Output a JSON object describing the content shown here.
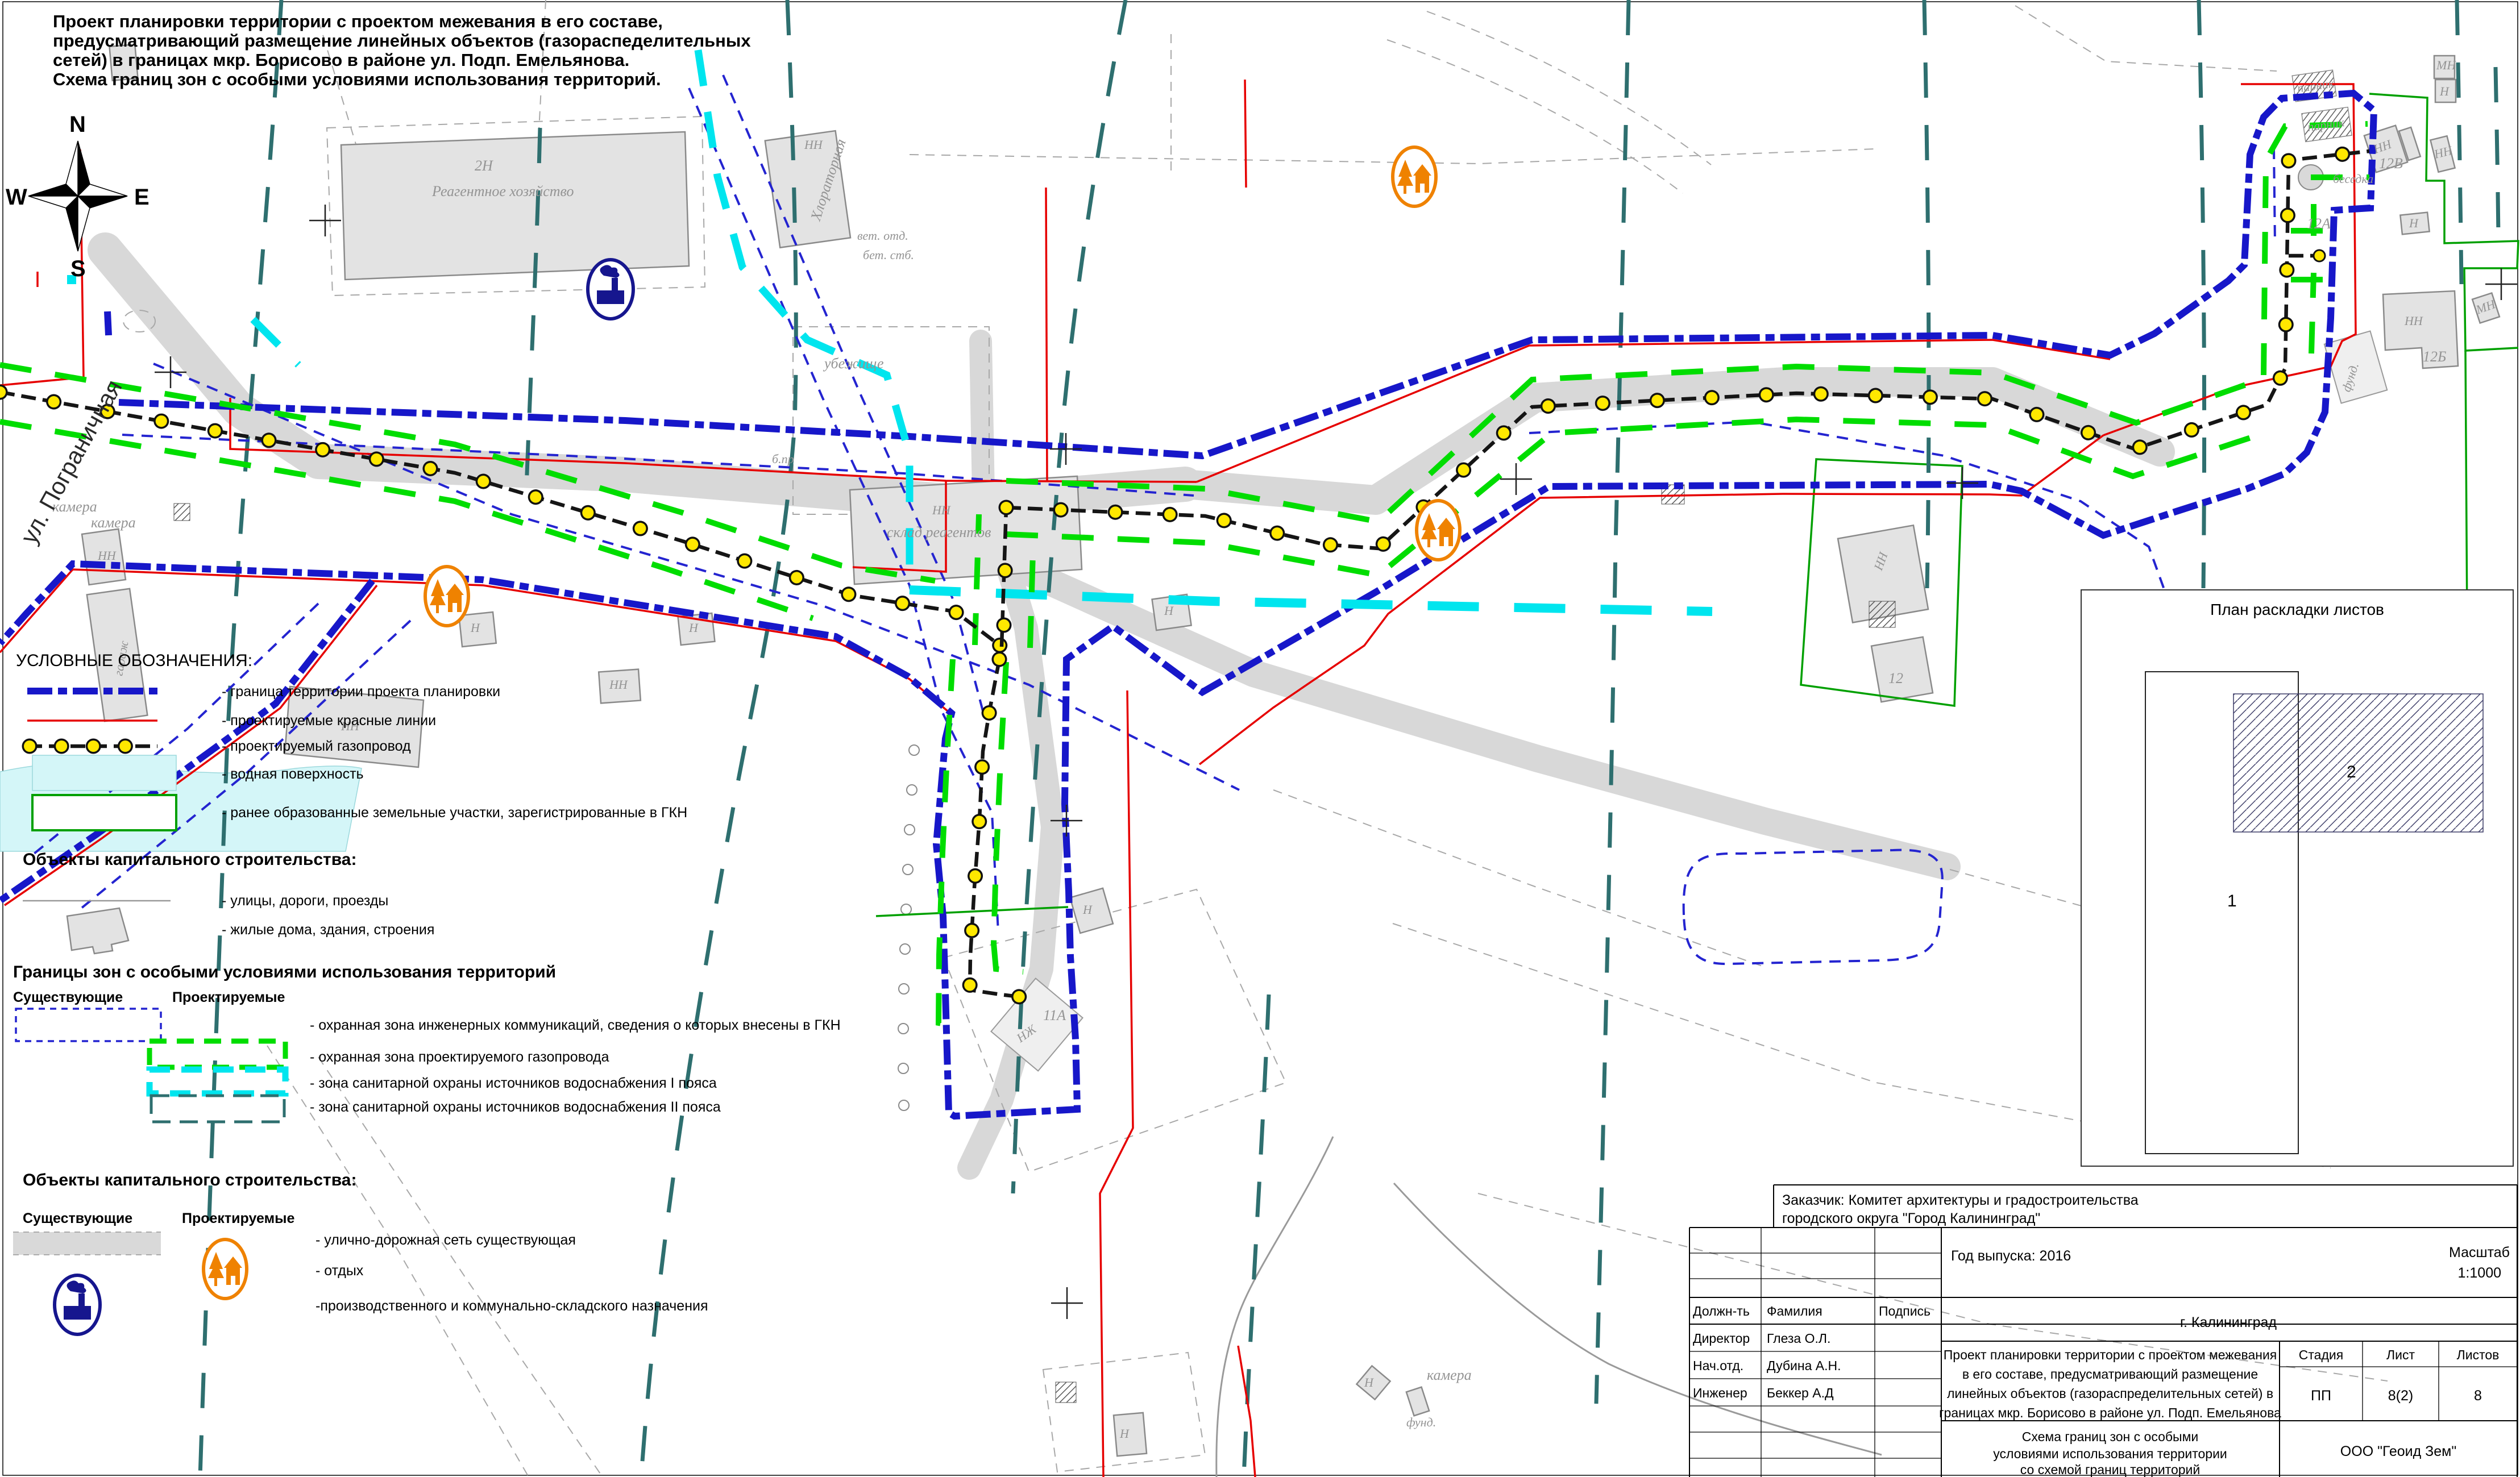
{
  "title": {
    "lines": [
      "Проект планировки территории с проектом межевания в его составе,",
      "предусматривающий размещение линейных объектов (газораспеделительных",
      "сетей) в границах мкр. Борисово в районе ул. Подп. Емельянова.",
      "Схема границ зон с особыми условиями использования территорий."
    ]
  },
  "compass": {
    "n": "N",
    "s": "S",
    "e": "E",
    "w": "W"
  },
  "colors": {
    "project_boundary": "#1717c9",
    "red_lines": "#e60000",
    "gas_pipeline_dots": "#ffe800",
    "gas_protect_zone": "#00dd00",
    "water_zone_1": "#00e5ee",
    "water_zone_2": "#2e6f6f",
    "existing_comm_zone": "#2424d0",
    "registered_parcel": "#00a000",
    "road": "#d8d8d8",
    "water_surface": "#d4f6f8",
    "building": "#e3e3e3",
    "recreation_icon": "#ef8200",
    "industrial_icon": "#16168e"
  },
  "legend": {
    "heading": "УСЛОВНЫЕ  ОБОЗНАЧЕНИЯ:",
    "items": [
      "- граница территории проекта планировки",
      "- проектируемые красные линии",
      "- проектируемый газопровод",
      "- водная поверхность",
      "- ранее образованные земельные участки, зарегистрированные в ГКН"
    ],
    "capital_heading": "Объекты капитального строительства:",
    "capital_items": [
      "- улицы, дороги, проезды",
      "- жилые дома, здания, строения"
    ],
    "zones_heading": "Границы зон с особыми условиями использования территорий",
    "col_existing": "Существующие",
    "col_projected": "Проектируемые",
    "zone_items": [
      "- охранная зона инженерных коммуникаций, сведения о которых внесены в ГКН",
      "- охранная зона проектируемого газопровода",
      "- зона санитарной охраны источников водоснабжения I пояса",
      "- зона санитарной охраны источников водоснабжения II пояса"
    ],
    "capital2_heading": "Объекты капитального строительства:",
    "capital2_items": [
      "- улично-дорожная сеть существующая",
      "- отдых",
      "-производственного и коммунально-складского назначения"
    ]
  },
  "layout_plan": {
    "title": "План раскладки листов",
    "sheet1": "1",
    "sheet2": "2"
  },
  "map_labels": {
    "street": "ул. Пограничная",
    "n2": "2Н",
    "reagent": "Реагентное хозяйство",
    "chlorator": "Хлораторная",
    "sklad": "склад реагентов",
    "shelter": "убежище",
    "garage": "гараж",
    "kamera": "камера",
    "vet": "вет. отд.",
    "bet": "бет. стб.",
    "bpr": "б.пр",
    "p11a": "11А",
    "p12": "12",
    "p12a": "12А",
    "p12b": "12Б",
    "p12v": "12В",
    "besedka": "беседка",
    "parnik": "парник",
    "fund": "фунд.",
    "nn": "НН",
    "n": "Н",
    "mn": "МН",
    "nzh": "НЖ"
  },
  "titleblock": {
    "client_line1": "Заказчик: Комитет архитектуры и градостроительства",
    "client_line2": "городского округа \"Город Калининград\"",
    "year": "Год выпуска: 2016",
    "scale_label": "Масштаб",
    "scale_value": "1:1000",
    "col_position": "Должн-ть",
    "col_name": "Фамилия",
    "col_sign": "Подпись",
    "rows": [
      {
        "position": "Директор",
        "name": "Глеза О.Л."
      },
      {
        "position": "Нач.отд.",
        "name": "Дубина А.Н."
      },
      {
        "position": "Инженер",
        "name": "Беккер А.Д"
      }
    ],
    "city": "г. Калининград",
    "project_lines": [
      "Проект планировки территории с проектом межевания",
      "в его составе, предусматривающий размещение",
      "линейных объектов (газораспределительных сетей) в",
      "границах мкр. Борисово в районе ул. Подп. Емельянова"
    ],
    "stage_label": "Стадия",
    "sheet_label": "Лист",
    "sheets_label": "Листов",
    "stage": "ПП",
    "sheet": "8(2)",
    "sheets": "8",
    "doc_lines": [
      "Схема границ зон с особыми",
      "условиями использования территории",
      "со схемой границ территорий"
    ],
    "company": "ООО \"Геоид Зем\""
  }
}
